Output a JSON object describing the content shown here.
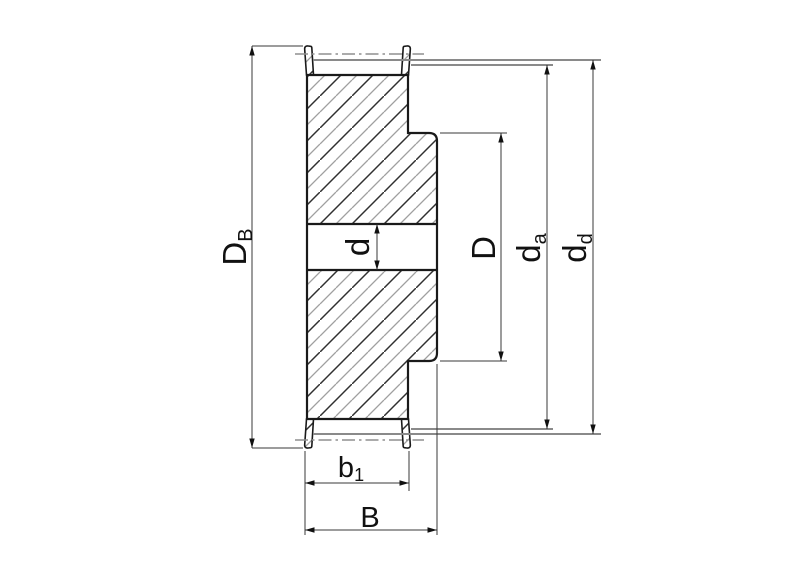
{
  "drawing": {
    "dimensions": {
      "flange_diameter": {
        "base": "D",
        "sub": "B"
      },
      "bore_diameter": {
        "base": "d",
        "sub": ""
      },
      "step_diameter": {
        "base": "D",
        "sub": ""
      },
      "outside_diameter": {
        "base": "d",
        "sub": "a"
      },
      "pitch_diameter": {
        "base": "d",
        "sub": "d"
      },
      "belt_width": {
        "base": "b",
        "sub": "1"
      },
      "overall_width": {
        "base": "B",
        "sub": ""
      }
    },
    "colors": {
      "background": "#ffffff",
      "outline": "#1a1a1a",
      "hatch_dark": "#303030",
      "hatch_light": "#a0a0a0",
      "reference_line": "#8a8a8a",
      "centerline": "#8f8f8f",
      "dimension_line": "#3a3a3a",
      "label": "#111111"
    }
  }
}
